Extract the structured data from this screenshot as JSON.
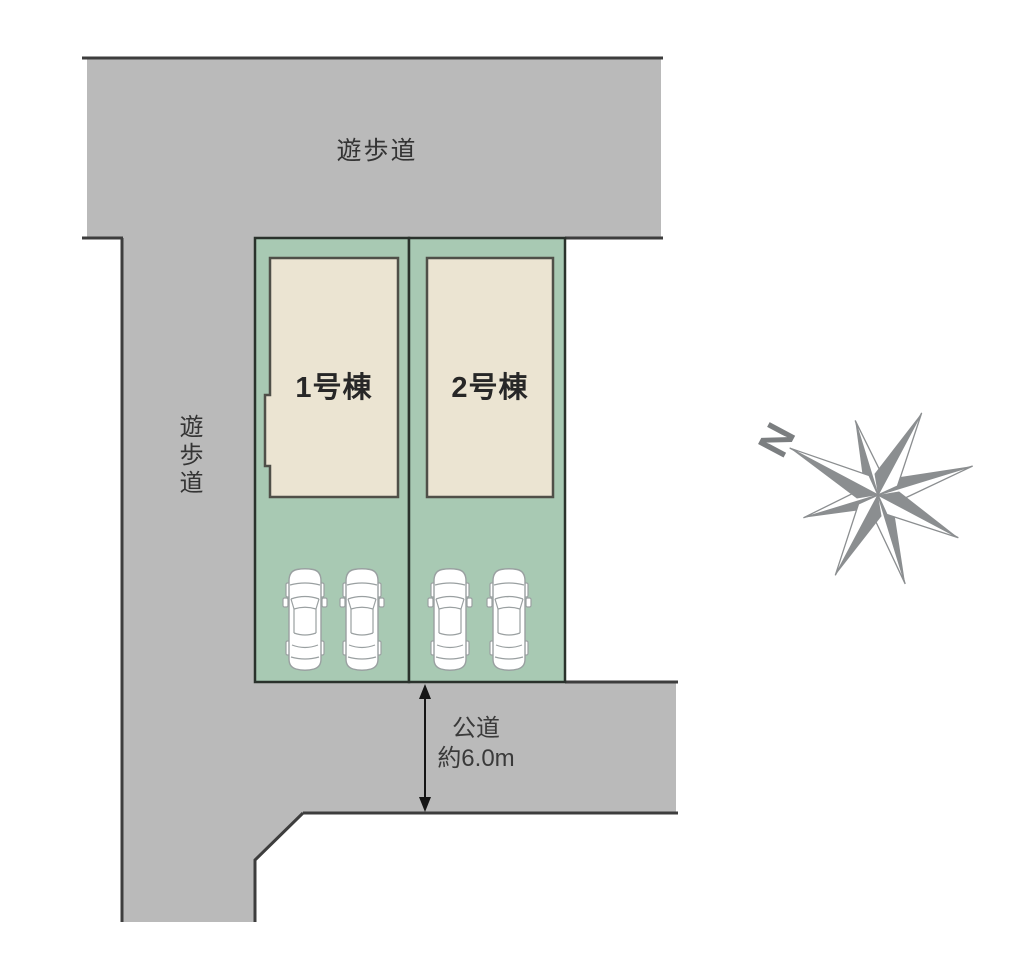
{
  "plan": {
    "promenade_top": {
      "label": "遊歩道"
    },
    "promenade_left": {
      "label": "遊歩道"
    },
    "lots": [
      {
        "name": "1号棟"
      },
      {
        "name": "2号棟"
      }
    ],
    "public_road": {
      "name": "公道",
      "width": "約6.0m"
    },
    "compass": {
      "north": "N"
    },
    "parking": {
      "cars": 4
    }
  },
  "colors": {
    "road_gray": "#bababa",
    "lot_green": "#a8c9b3",
    "building_beige": "#ebe4d2",
    "border_dark": "#3d3d3d",
    "compass_gray": "#8b8e90"
  }
}
